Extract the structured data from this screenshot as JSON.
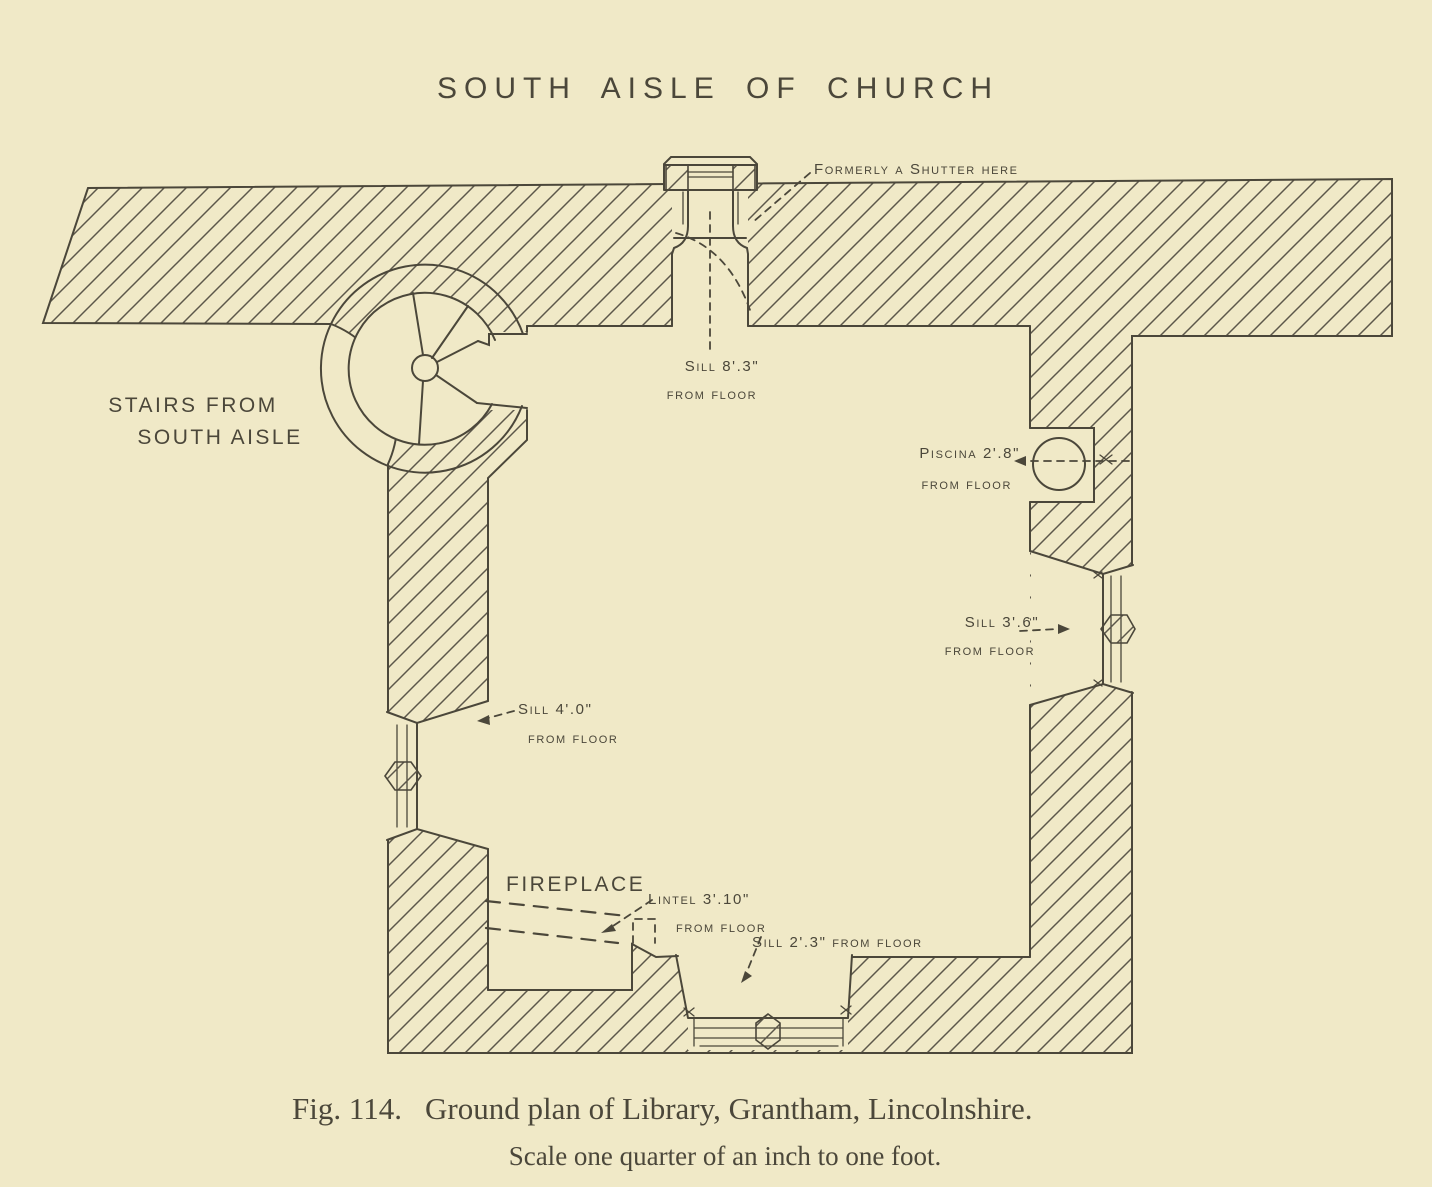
{
  "colors": {
    "paper": "#f0e9c7",
    "ink": "#4b473a",
    "hatch": "#5c574a"
  },
  "title": "SOUTH AISLE OF CHURCH",
  "labels": {
    "shutter": "Formerly a Shutter here",
    "stairs1": "STAIRS FROM",
    "stairs2": "SOUTH AISLE",
    "sill_top1": "Sill 8'.3\"",
    "sill_top2": "from floor",
    "piscina1": "Piscina 2'.8\"",
    "piscina2": "from floor",
    "sill_right1": "Sill 3'.6\"",
    "sill_right2": "from floor",
    "sill_left1": "Sill 4'.0\"",
    "sill_left2": "from floor",
    "fireplace": "FIREPLACE",
    "lintel1": "Lintel 3'.10\"",
    "lintel2": "from floor",
    "sill_bottom": "Sill 2'.3\" from floor"
  },
  "caption": {
    "figure": "Fig. 114.",
    "text": "Ground plan of Library, Grantham, Lincolnshire.",
    "scale": "Scale one quarter of an inch to one foot."
  }
}
